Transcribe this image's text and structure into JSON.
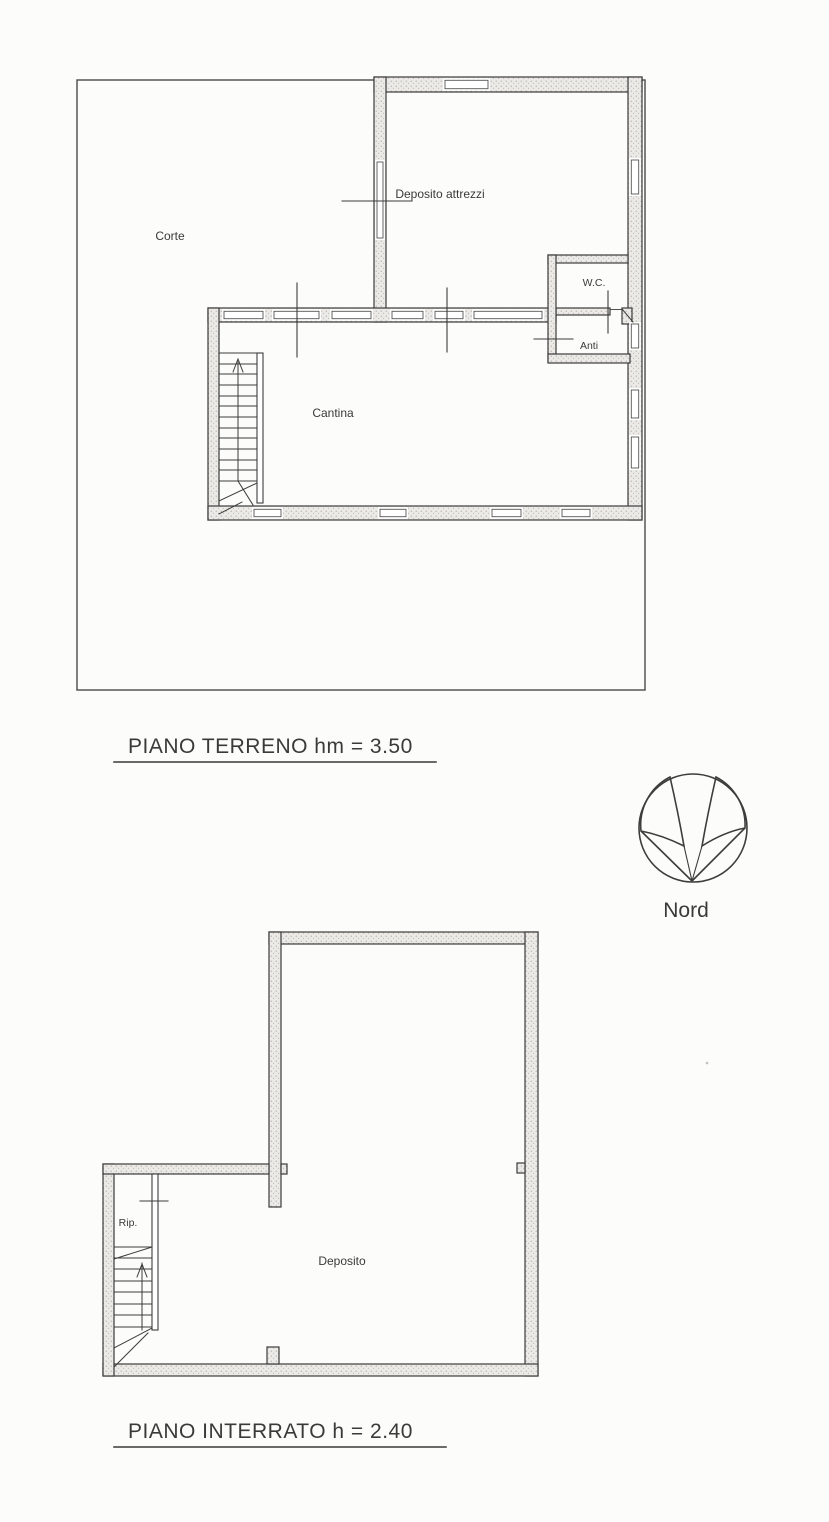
{
  "ground_floor": {
    "title": "PIANO TERRENO hm = 3.50",
    "rooms": {
      "corte": "Corte",
      "deposito_attrezzi": "Deposito attrezzi",
      "wc": "W.C.",
      "anti": "Anti",
      "cantina": "Cantina"
    }
  },
  "basement": {
    "title": "PIANO INTERRATO h = 2.40",
    "rooms": {
      "rip": "Rip.",
      "deposito": "Deposito"
    }
  },
  "compass": {
    "label": "Nord"
  },
  "colors": {
    "ink": "#3b3b3b",
    "paper": "#fcfcfb"
  }
}
